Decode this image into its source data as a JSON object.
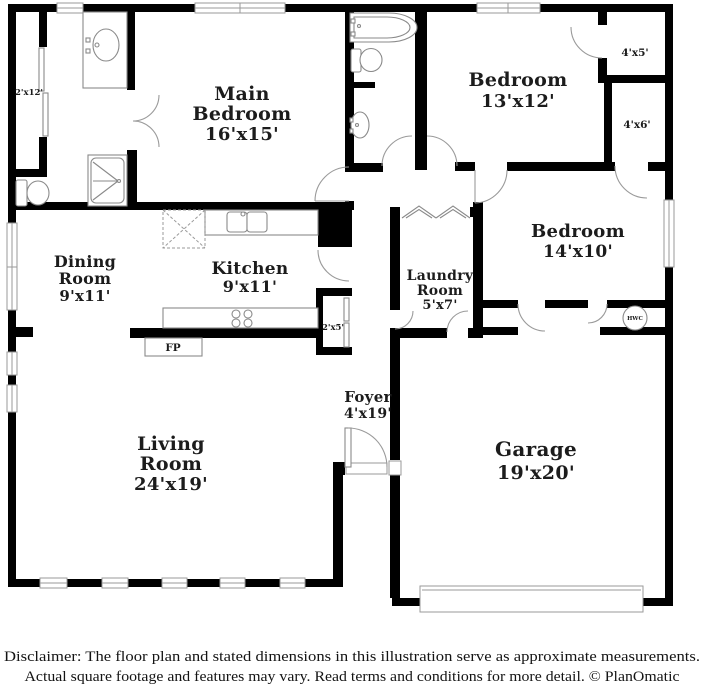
{
  "plan": {
    "rooms": {
      "main_bedroom": {
        "lines": [
          "Main",
          "Bedroom",
          "16'x15'"
        ]
      },
      "bedroom_13": {
        "lines": [
          "Bedroom",
          "13'x12'"
        ]
      },
      "bedroom_14": {
        "lines": [
          "Bedroom",
          "14'x10'"
        ]
      },
      "dining": {
        "lines": [
          "Dining",
          "Room",
          "9'x11'"
        ]
      },
      "kitchen": {
        "lines": [
          "Kitchen",
          "9'x11'"
        ]
      },
      "laundry": {
        "lines": [
          "Laundry",
          "Room",
          "5'x7'"
        ]
      },
      "foyer": {
        "lines": [
          "Foyer",
          "4'x19'"
        ]
      },
      "living": {
        "lines": [
          "Living",
          "Room",
          "24'x19'"
        ]
      },
      "garage": {
        "lines": [
          "Garage",
          "19'x20'"
        ]
      }
    },
    "closets": {
      "c_2x12": "2'x12'",
      "c_4x5": "4'x5'",
      "c_4x6": "4'x6'",
      "c_2x5": "2'x5'"
    },
    "fixtures": {
      "fireplace": "FP",
      "water_heater": "HWC"
    }
  },
  "footer": {
    "line1": "Disclaimer: The floor plan and stated dimensions in this illustration serve as approximate measurements.",
    "line2": "Actual square footage and features may vary. Read terms and conditions for more detail. © PlanOmatic"
  },
  "colors": {
    "wall": "#000000",
    "fixture_line": "#8a8a8a",
    "label_text": "#1c1c1c"
  }
}
